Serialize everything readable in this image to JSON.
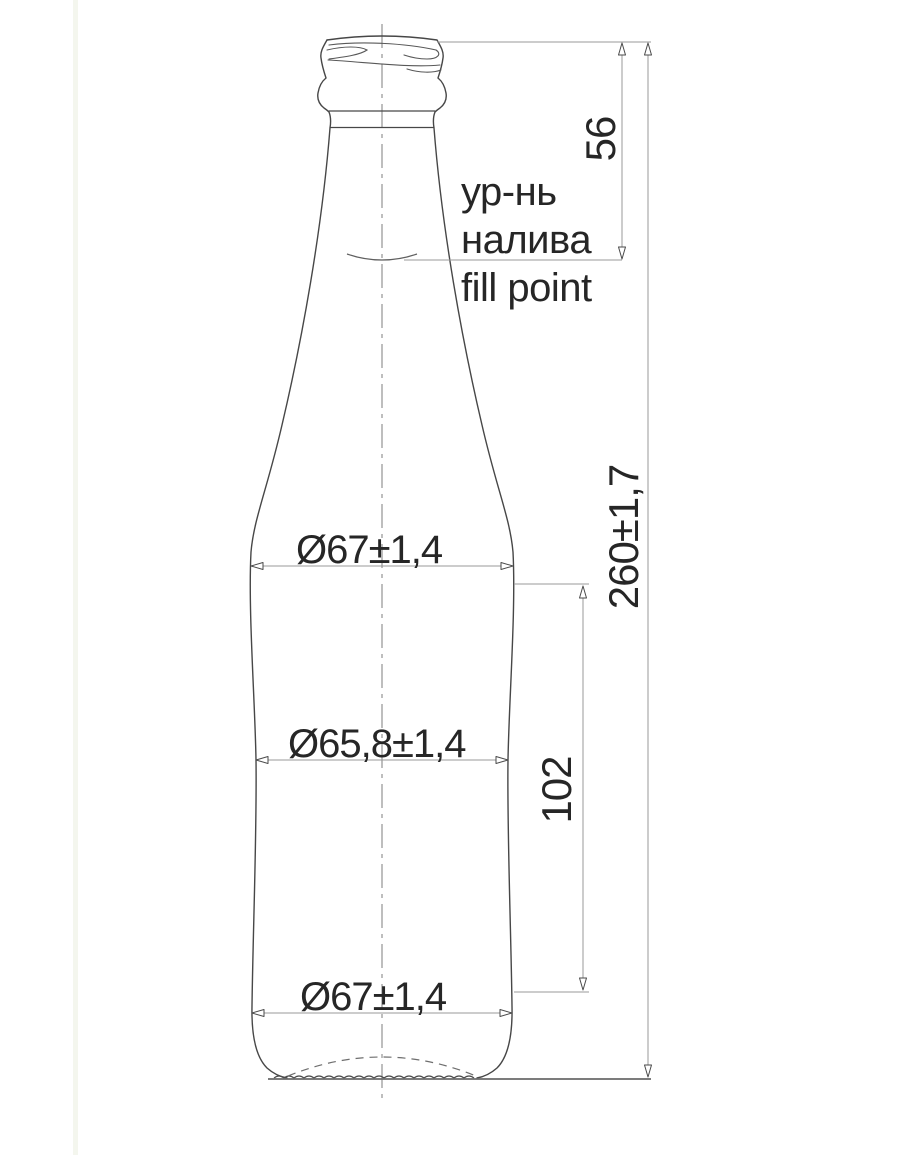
{
  "drawing": {
    "title": "Glass bottle technical drawing with dimensions",
    "annotations": {
      "fill_level_ru_line1": "ур-нь",
      "fill_level_ru_line2": "налива",
      "fill_level_en": "fill point"
    },
    "dimensions": {
      "top_to_fill_point": "56",
      "overall_height": "260±1,7",
      "lower_body_height": "102",
      "shoulder_diameter": "Ø67±1,4",
      "waist_diameter": "Ø65,8±1,4",
      "base_diameter": "Ø67±1,4"
    },
    "colors": {
      "background": "#ffffff",
      "outline": "#474747",
      "dimension_line": "#9a9a9a",
      "text": "#262626"
    }
  }
}
